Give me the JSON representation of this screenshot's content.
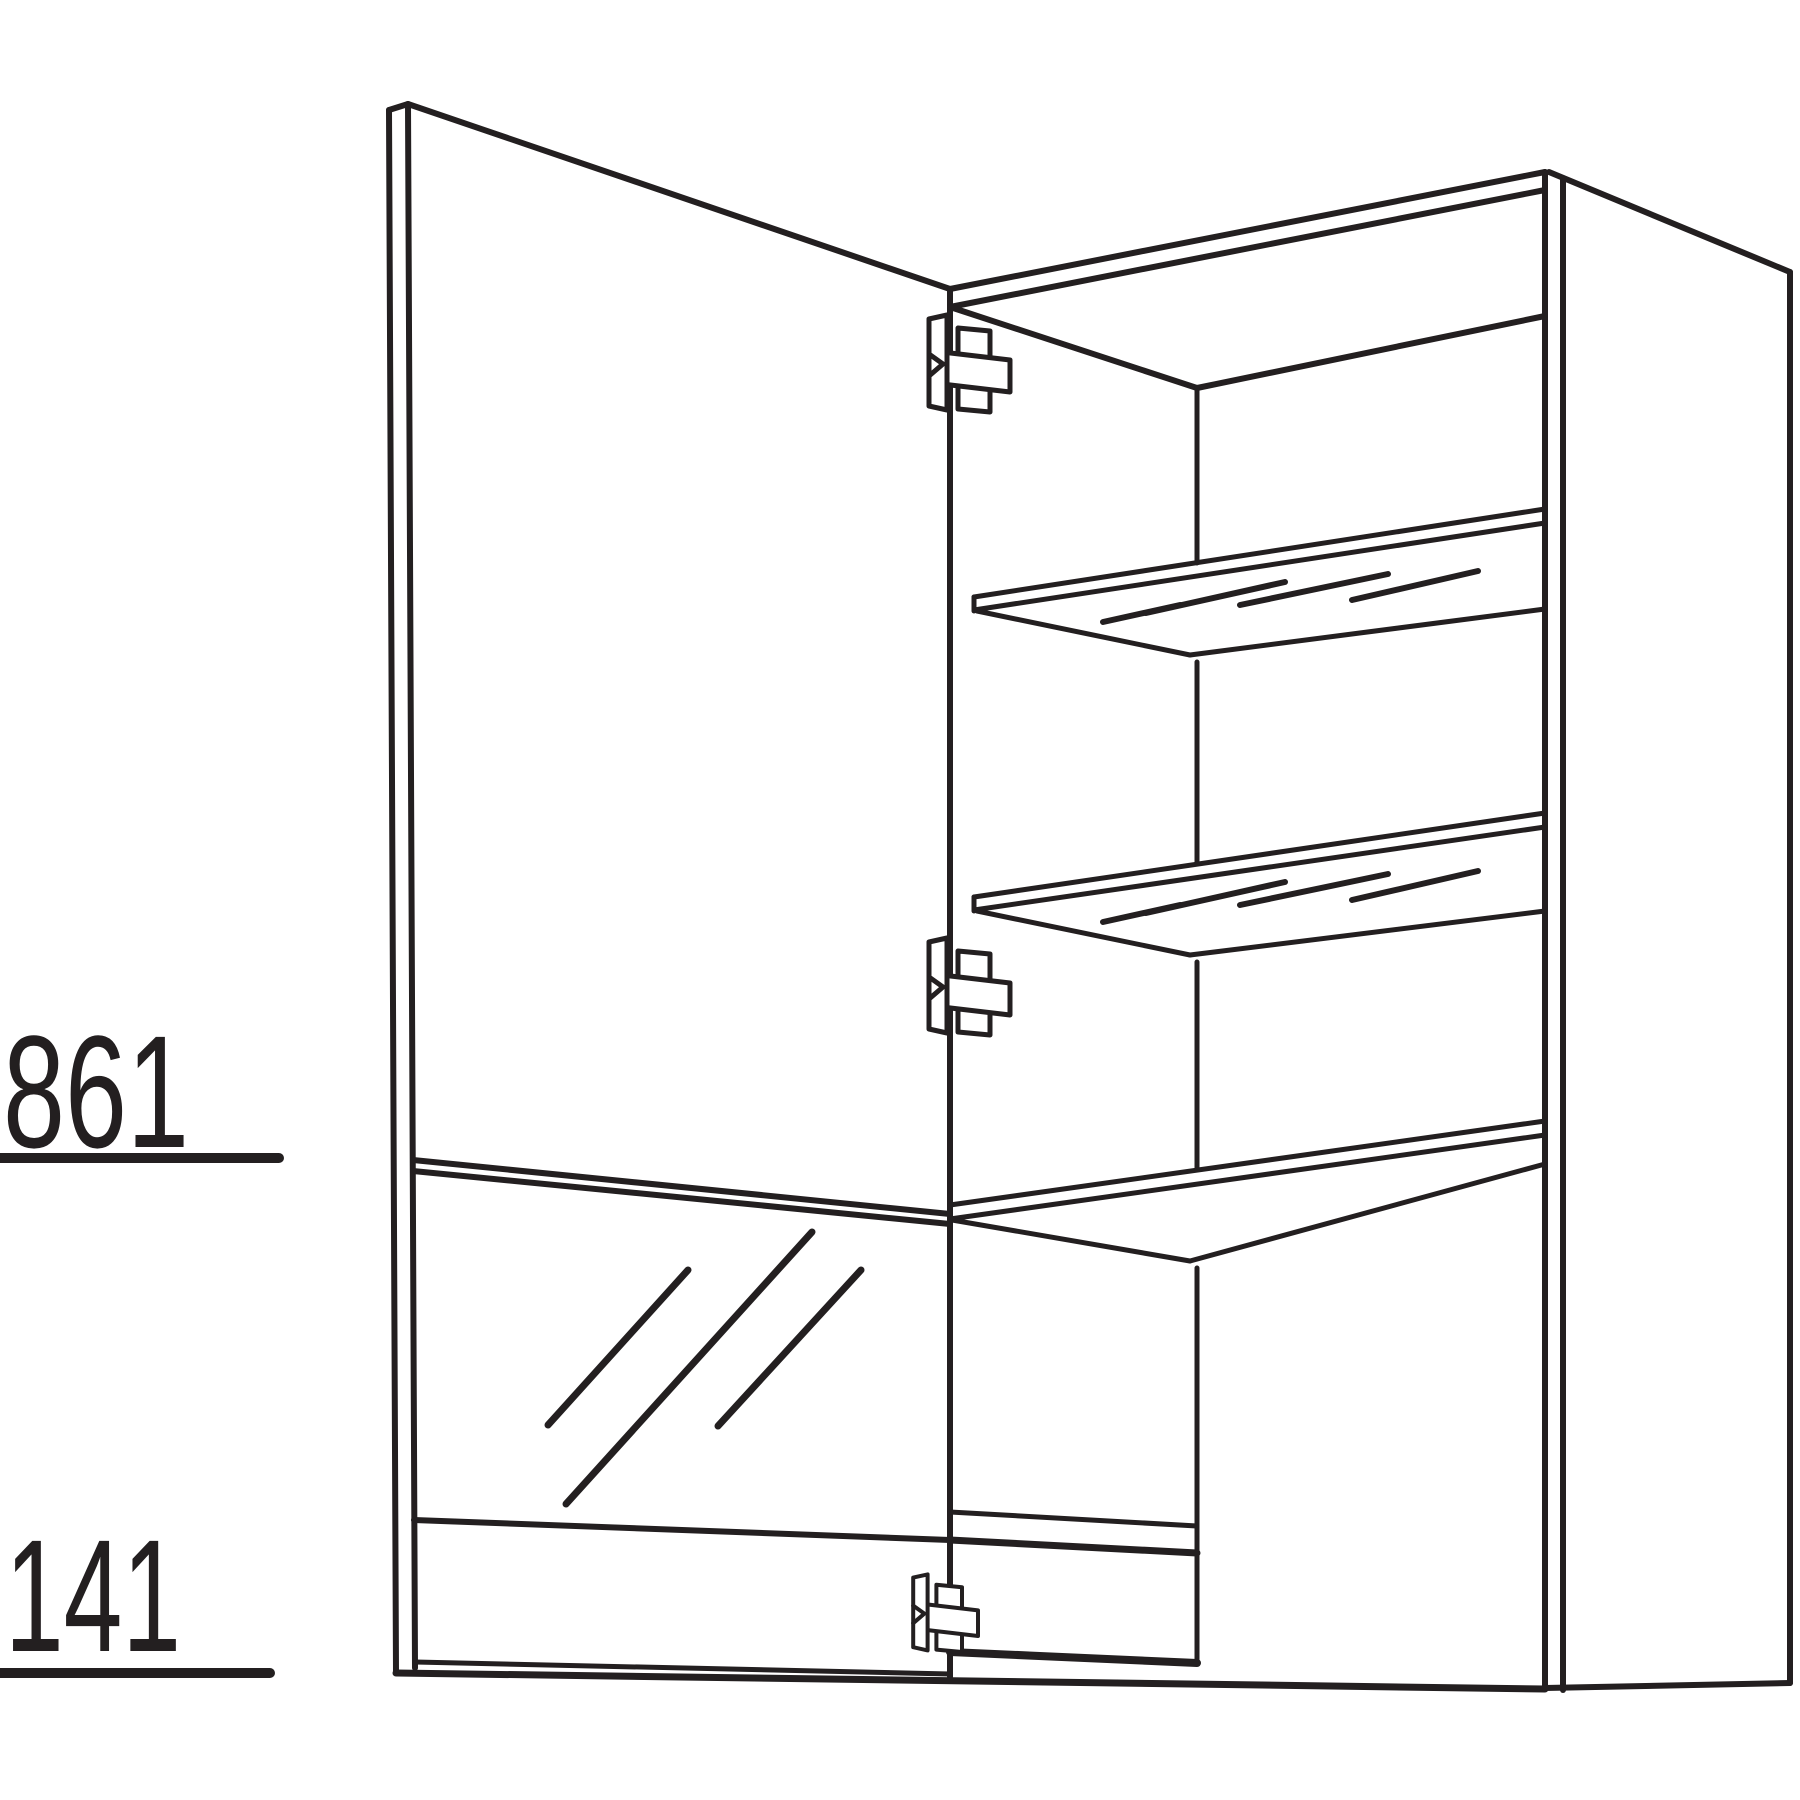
{
  "diagram": {
    "background_color": "#ffffff",
    "line_color": "#231f20",
    "dimension_labels": {
      "upper_section_height": "861",
      "lower_section_height": "141"
    },
    "parts": [
      "open-door",
      "lower-glass-door",
      "upper-glass-shelf",
      "lower-glass-shelf",
      "fixed-shelf",
      "top-hinge",
      "middle-hinge",
      "bottom-hinge",
      "cabinet-carcass"
    ]
  }
}
